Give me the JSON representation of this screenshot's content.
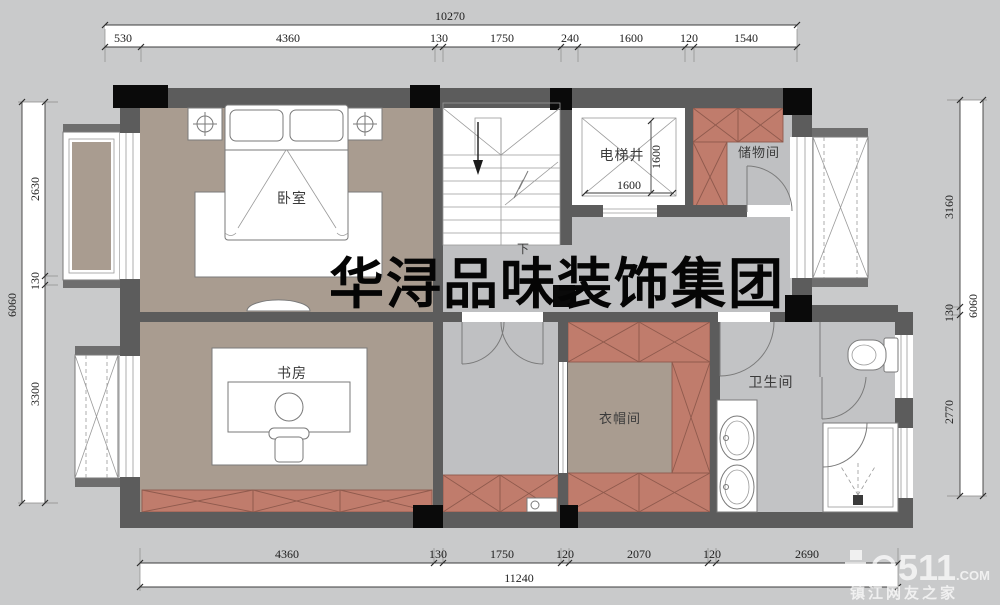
{
  "watermark": "华浔品味装饰集团",
  "site_watermark": {
    "number": "511",
    "tld": ".COM",
    "tagline": "镇江网友之家"
  },
  "rooms": {
    "bedroom": "卧室",
    "study": "书房",
    "elevator_shaft": "电梯井",
    "storage": "储物间",
    "cloakroom": "衣帽间",
    "bathroom": "卫生间",
    "stairs_down": "下"
  },
  "dims": {
    "top": {
      "total": "10270",
      "segments": [
        "530",
        "4360",
        "130",
        "1750",
        "240",
        "1600",
        "120",
        "1540"
      ]
    },
    "bottom": {
      "total": "11240",
      "segments": [
        "4360",
        "130",
        "1750",
        "120",
        "2070",
        "120",
        "2690"
      ]
    },
    "left": {
      "total": "6060",
      "segments": [
        "2630",
        "130",
        "3300"
      ]
    },
    "right": {
      "total": "6060",
      "segments": [
        "3160",
        "130",
        "2770"
      ]
    },
    "elevator": {
      "width": "1600",
      "depth": "1600"
    }
  },
  "colors": {
    "wall": "#5c5c5c",
    "column": "#0a0a0a",
    "floor_taupe": "#a99c90",
    "floor_gray": "#bfc0c2",
    "cabinet_terracotta": "#c07c6c",
    "background": "#c9cacb"
  }
}
